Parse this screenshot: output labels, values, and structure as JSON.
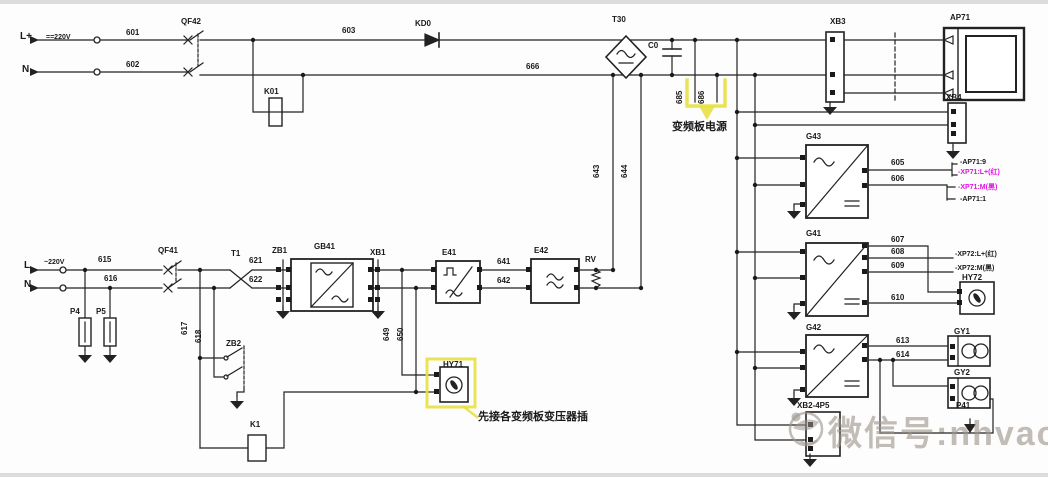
{
  "diagram": {
    "colors": {
      "text": "#1a1a1a",
      "line": "#222222",
      "magenta": "#e310e3",
      "highlight": "#e8e044",
      "watermark": "rgba(158,148,140,0.62)",
      "background": "#ffffff"
    },
    "watermark": {
      "text": "微信号:nhvaca"
    },
    "annotations": {
      "inverter_power": "变频板电源",
      "hy71_callout": "先接各变频板变压器插"
    },
    "labels": [
      {
        "id": "terminal-l-plus",
        "t": "L+",
        "x": 20,
        "y": 32,
        "s": 10
      },
      {
        "id": "dc-220v",
        "t": "==220V",
        "x": 46,
        "y": 34,
        "s": 7
      },
      {
        "id": "terminal-n-top",
        "t": "N",
        "x": 22,
        "y": 65,
        "s": 10
      },
      {
        "id": "wire-601",
        "t": "601",
        "x": 126,
        "y": 29
      },
      {
        "id": "wire-602",
        "t": "602",
        "x": 126,
        "y": 61
      },
      {
        "id": "breaker-qf42",
        "t": "QF42",
        "x": 181,
        "y": 18
      },
      {
        "id": "relay-k01",
        "t": "K01",
        "x": 264,
        "y": 88
      },
      {
        "id": "wire-603",
        "t": "603",
        "x": 342,
        "y": 27
      },
      {
        "id": "diode-kd0",
        "t": "KD0",
        "x": 415,
        "y": 20
      },
      {
        "id": "wire-666",
        "t": "666",
        "x": 526,
        "y": 63
      },
      {
        "id": "rectifier-t30",
        "t": "T30",
        "x": 612,
        "y": 16
      },
      {
        "id": "capacitor-c0",
        "t": "C0",
        "x": 648,
        "y": 42
      },
      {
        "id": "wire-685",
        "t": "685",
        "x": 684,
        "y": 96,
        "v": 1
      },
      {
        "id": "wire-686",
        "t": "686",
        "x": 706,
        "y": 96,
        "v": 1
      },
      {
        "id": "ann-inverter-power",
        "t": "变频板电源",
        "x": 672,
        "y": 122,
        "s": 11
      },
      {
        "id": "wire-643",
        "t": "643",
        "x": 601,
        "y": 170,
        "v": 1
      },
      {
        "id": "wire-644",
        "t": "644",
        "x": 629,
        "y": 170,
        "v": 1
      },
      {
        "id": "connector-xb3",
        "t": "XB3",
        "x": 830,
        "y": 18
      },
      {
        "id": "module-ap71",
        "t": "AP71",
        "x": 950,
        "y": 14
      },
      {
        "id": "connector-xb4",
        "t": "XB4",
        "x": 946,
        "y": 94
      },
      {
        "id": "converter-g43",
        "t": "G43",
        "x": 806,
        "y": 133
      },
      {
        "id": "wire-605",
        "t": "605",
        "x": 891,
        "y": 159
      },
      {
        "id": "wire-606",
        "t": "606",
        "x": 891,
        "y": 175
      },
      {
        "id": "ref-ap71-9",
        "t": "-AP71:9",
        "x": 960,
        "y": 159,
        "s": 7
      },
      {
        "id": "ref-xp71-l",
        "t": "-XP71:L+(红)",
        "x": 958,
        "y": 169,
        "s": 7,
        "c": "magenta"
      },
      {
        "id": "ref-xp71-m",
        "t": "-XP71:M(黑)",
        "x": 958,
        "y": 184,
        "s": 7,
        "c": "magenta"
      },
      {
        "id": "ref-ap71-1",
        "t": "-AP71:1",
        "x": 960,
        "y": 196,
        "s": 7
      },
      {
        "id": "converter-g41",
        "t": "G41",
        "x": 806,
        "y": 230
      },
      {
        "id": "wire-607",
        "t": "607",
        "x": 891,
        "y": 236
      },
      {
        "id": "wire-608",
        "t": "608",
        "x": 891,
        "y": 248
      },
      {
        "id": "wire-609",
        "t": "609",
        "x": 891,
        "y": 262
      },
      {
        "id": "ref-xp72-l",
        "t": "-XP72:L+(红)",
        "x": 955,
        "y": 251,
        "s": 7
      },
      {
        "id": "ref-xp72-m",
        "t": "-XP72:M(黑)",
        "x": 955,
        "y": 265,
        "s": 7
      },
      {
        "id": "indicator-hy72",
        "t": "HY72",
        "x": 962,
        "y": 274
      },
      {
        "id": "wire-610",
        "t": "610",
        "x": 891,
        "y": 294
      },
      {
        "id": "converter-g42",
        "t": "G42",
        "x": 806,
        "y": 324
      },
      {
        "id": "wire-613",
        "t": "613",
        "x": 896,
        "y": 337
      },
      {
        "id": "wire-614",
        "t": "614",
        "x": 896,
        "y": 351
      },
      {
        "id": "fan-gy1",
        "t": "GY1",
        "x": 954,
        "y": 328
      },
      {
        "id": "fan-gy2",
        "t": "GY2",
        "x": 954,
        "y": 369
      },
      {
        "id": "arrester-p41",
        "t": "P41",
        "x": 956,
        "y": 402
      },
      {
        "id": "connector-xb2-4p5",
        "t": "XB2-4P5",
        "x": 797,
        "y": 402
      },
      {
        "id": "terminal-l",
        "t": "L",
        "x": 24,
        "y": 261,
        "s": 10
      },
      {
        "id": "ac-220v",
        "t": "~220V",
        "x": 44,
        "y": 259,
        "s": 7
      },
      {
        "id": "terminal-n-bot",
        "t": "N",
        "x": 24,
        "y": 280,
        "s": 10
      },
      {
        "id": "wire-615",
        "t": "615",
        "x": 98,
        "y": 256
      },
      {
        "id": "wire-616",
        "t": "616",
        "x": 104,
        "y": 275
      },
      {
        "id": "arrester-p4",
        "t": "P4",
        "x": 70,
        "y": 308
      },
      {
        "id": "arrester-p5",
        "t": "P5",
        "x": 96,
        "y": 308
      },
      {
        "id": "breaker-qf41",
        "t": "QF41",
        "x": 158,
        "y": 247
      },
      {
        "id": "wire-617",
        "t": "617",
        "x": 189,
        "y": 327,
        "v": 1
      },
      {
        "id": "wire-618",
        "t": "618",
        "x": 203,
        "y": 335,
        "v": 1
      },
      {
        "id": "transformer-t1",
        "t": "T1",
        "x": 231,
        "y": 250
      },
      {
        "id": "wire-621",
        "t": "621",
        "x": 249,
        "y": 257
      },
      {
        "id": "wire-622",
        "t": "622",
        "x": 249,
        "y": 276
      },
      {
        "id": "connector-zb1",
        "t": "ZB1",
        "x": 272,
        "y": 247
      },
      {
        "id": "converter-gb41",
        "t": "GB41",
        "x": 314,
        "y": 243
      },
      {
        "id": "connector-xb1",
        "t": "XB1",
        "x": 370,
        "y": 249
      },
      {
        "id": "converter-e41",
        "t": "E41",
        "x": 442,
        "y": 249
      },
      {
        "id": "wire-641",
        "t": "641",
        "x": 497,
        "y": 258
      },
      {
        "id": "wire-642",
        "t": "642",
        "x": 497,
        "y": 277
      },
      {
        "id": "converter-e42",
        "t": "E42",
        "x": 534,
        "y": 247
      },
      {
        "id": "varistor-rv",
        "t": "RV",
        "x": 585,
        "y": 256
      },
      {
        "id": "contact-zb2",
        "t": "ZB2",
        "x": 226,
        "y": 340
      },
      {
        "id": "relay-k1",
        "t": "K1",
        "x": 250,
        "y": 421
      },
      {
        "id": "wire-649",
        "t": "649",
        "x": 391,
        "y": 333,
        "v": 1
      },
      {
        "id": "wire-650",
        "t": "650",
        "x": 405,
        "y": 333,
        "v": 1
      },
      {
        "id": "indicator-hy71",
        "t": "HY71",
        "x": 443,
        "y": 361
      },
      {
        "id": "ann-hy71-callout",
        "t": "先接各变频板变压器插",
        "x": 478,
        "y": 412,
        "s": 11
      }
    ]
  }
}
